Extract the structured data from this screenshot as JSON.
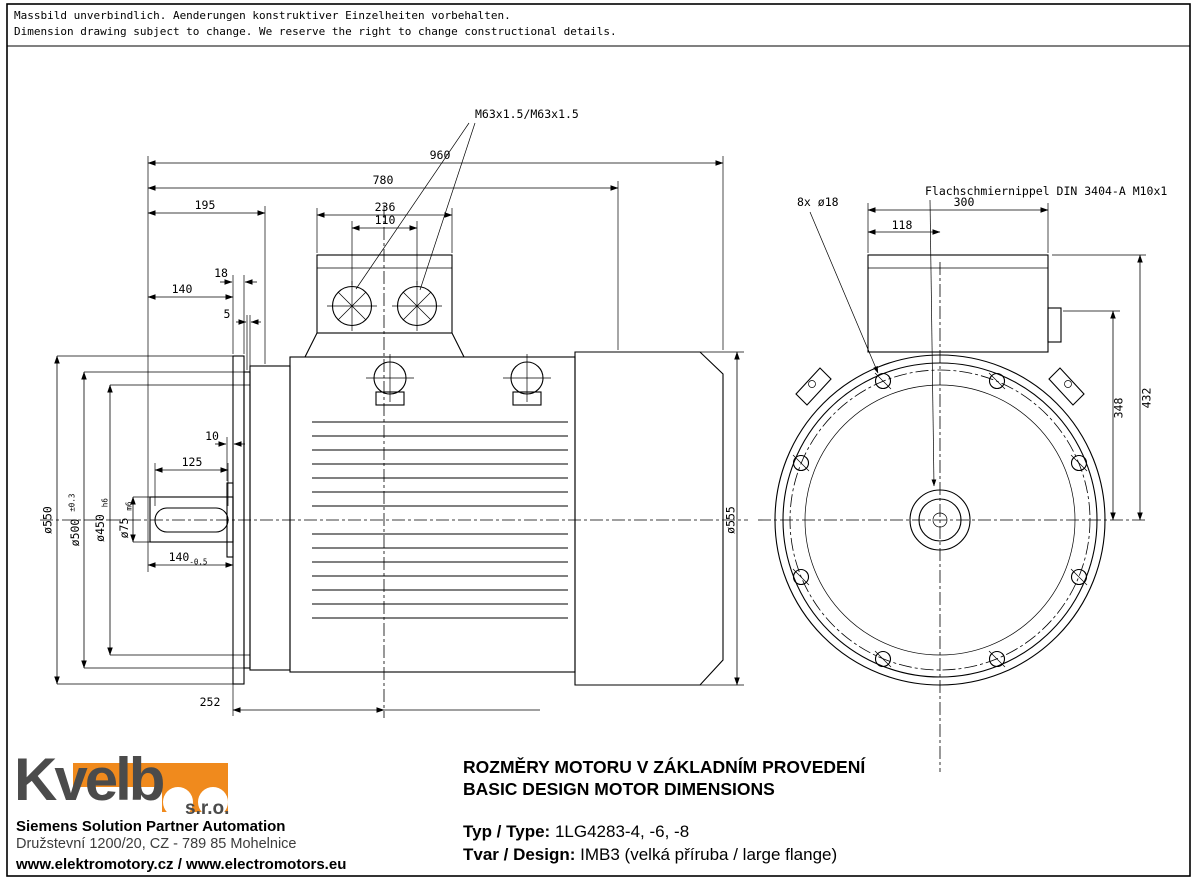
{
  "disclaimer": {
    "de": "Massbild unverbindlich. Aenderungen konstruktiver Einzelheiten vorbehalten.",
    "en": "Dimension drawing subject to change. We reserve the right to change constructional details."
  },
  "side_view": {
    "thread_label": "M63x1.5/M63x1.5",
    "dims": {
      "overall_length": "960",
      "housing_length": "780",
      "front_length": "195",
      "box_width": "236",
      "gland_spacing": "110",
      "flange_thickness": "18",
      "shaft_length": "140",
      "step": "5",
      "shoulder": "10",
      "key_length": "125",
      "shaft_dia": "ø75",
      "shaft_dia_tol": "m6",
      "shaft_ext": "140",
      "shaft_ext_tol": "-0.5",
      "flange_to_foot": "252",
      "flange_outer_dia": "ø550",
      "bolt_circle_dia": "ø500",
      "bolt_circle_tol": "±0.3",
      "spigot_dia": "ø450",
      "spigot_tol": "h6",
      "fan_cover_dia": "ø555"
    }
  },
  "front_view": {
    "holes_label": "8x ø18",
    "grease_nipple_label": "Flachschmiernippel DIN 3404-A M10x1",
    "dims": {
      "box_total_width": "300",
      "box_offset": "118",
      "height_to_box_top": "432",
      "height_to_port": "348"
    }
  },
  "footer": {
    "logo_word": "Kvelb",
    "logo_suffix": "s.r.o.",
    "partner_line": "Siemens Solution Partner Automation",
    "address_line": "Družstevní 1200/20, CZ - 789 85 Mohelnice",
    "web_line": "www.elektromotory.cz / www.electromotors.eu",
    "title_cz": "ROZMĚRY MOTORU V ZÁKLADNÍM PROVEDENÍ",
    "title_en": "BASIC DESIGN MOTOR DIMENSIONS",
    "type_label": "Typ / Type:",
    "type_value": "1LG4283-4, -6, -8",
    "design_label": "Tvar / Design:",
    "design_value": "IMB3 (velká příruba / large flange)"
  },
  "colors": {
    "accent": "#F08A1D",
    "line": "#000000"
  }
}
